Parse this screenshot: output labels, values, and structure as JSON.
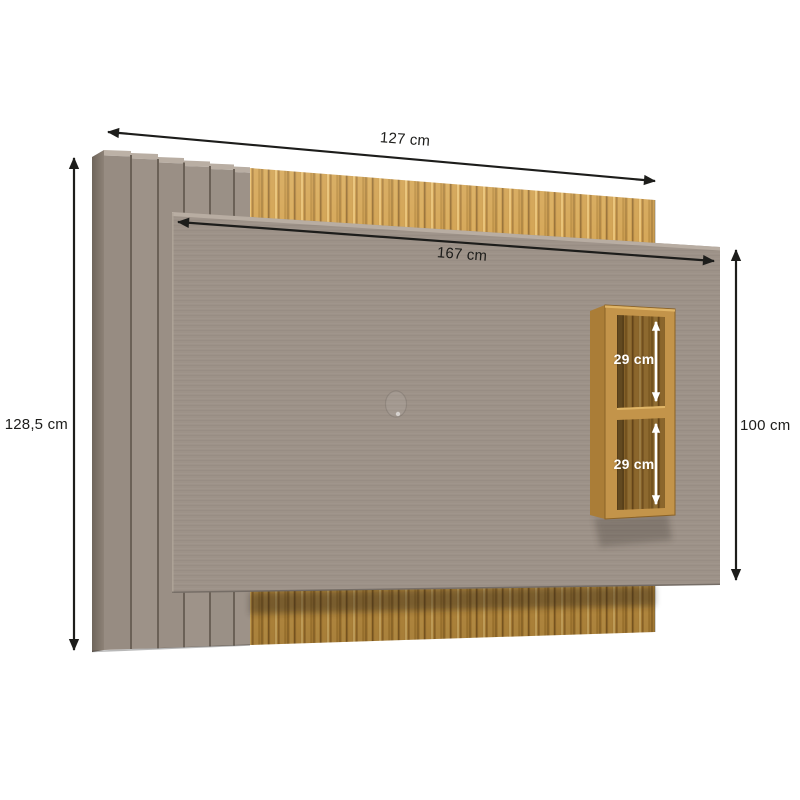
{
  "diagram": {
    "type": "furniture-dimension-diagram",
    "subject": "wall TV panel with slatted side detail, wood back panel and two-compartment shelf niche",
    "background": "#ffffff",
    "labels": {
      "overall_width": "127 cm",
      "front_panel_width": "167 cm",
      "overall_height": "128,5 cm",
      "front_panel_height": "100 cm",
      "niche_upper_height": "29 cm",
      "niche_lower_height": "29 cm"
    },
    "colors": {
      "panel_taupe": "#9d9288",
      "panel_bevel": "#b9aea3",
      "slat_groove": "#6b6157",
      "wood_base": "#c6933f",
      "wood_light": "#e2b65f",
      "wood_dark": "#9c7030",
      "niche_frame": "#b9893f",
      "niche_interior": "#6f5126",
      "dimension_line": "#1d1d1b",
      "niche_dimension_text": "#ffffff"
    }
  }
}
